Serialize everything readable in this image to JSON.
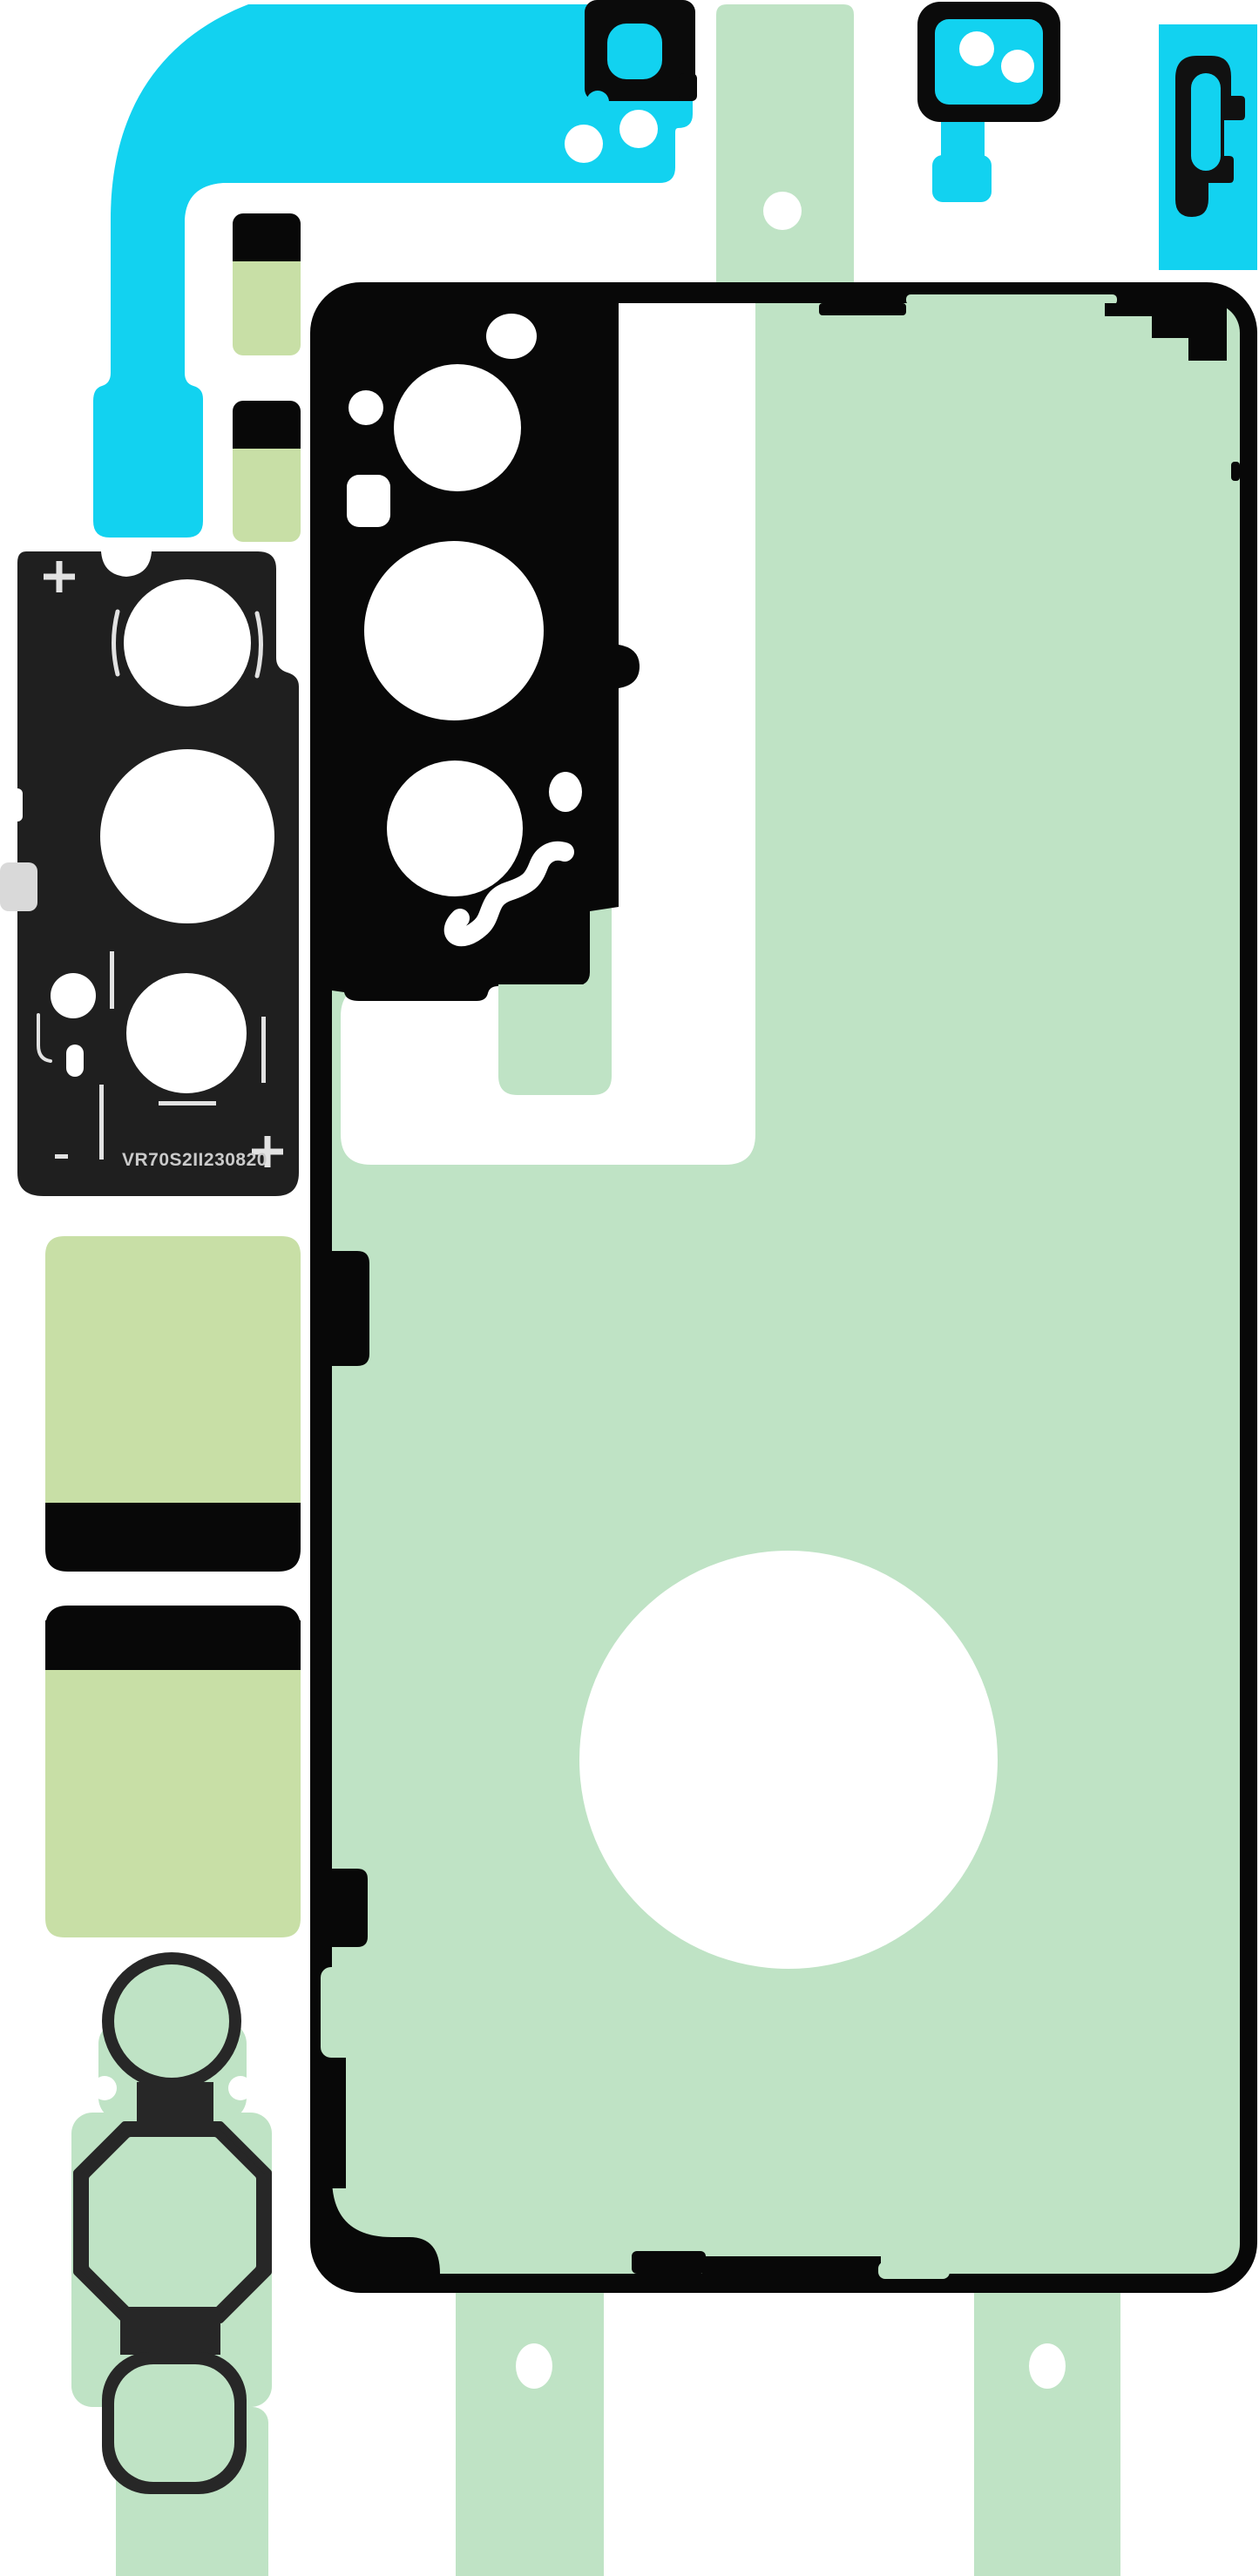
{
  "product": {
    "serial": "VR70S2II230820"
  },
  "colors": {
    "white": "#ffffff",
    "cyan": "#12d2f0",
    "mint": "#bfe3c5",
    "lime": "#c8dfa6",
    "ink": "#080808",
    "piece-black": "#0b0b0b",
    "bezel-black": "#1f1f1f",
    "gasket-black": "#272727",
    "marking": "#cacaca",
    "fiducial": "#e2e2e2",
    "tab-gray": "#d9d9d9"
  },
  "pieces": [
    {
      "name": "backing-film-strip-top",
      "color": "mint"
    },
    {
      "name": "backing-film-strip-bottom-left",
      "color": "mint"
    },
    {
      "name": "backing-film-strip-bottom-right",
      "color": "mint"
    },
    {
      "name": "main-flex-adhesive",
      "color": "cyan"
    },
    {
      "name": "camera-connector-adhesive",
      "color": "piece-black"
    },
    {
      "name": "lens-bracket-adhesive",
      "color": "cyan"
    },
    {
      "name": "side-bracket-adhesive",
      "color": "cyan"
    },
    {
      "name": "camera-bezel-gasket",
      "color": "bezel-black"
    },
    {
      "name": "back-cover-adhesive",
      "color": "mint"
    },
    {
      "name": "battery-pad-top",
      "color": "lime"
    },
    {
      "name": "battery-pad-bottom",
      "color": "lime"
    },
    {
      "name": "camera-ring-gasket",
      "color": "gasket-black"
    }
  ]
}
